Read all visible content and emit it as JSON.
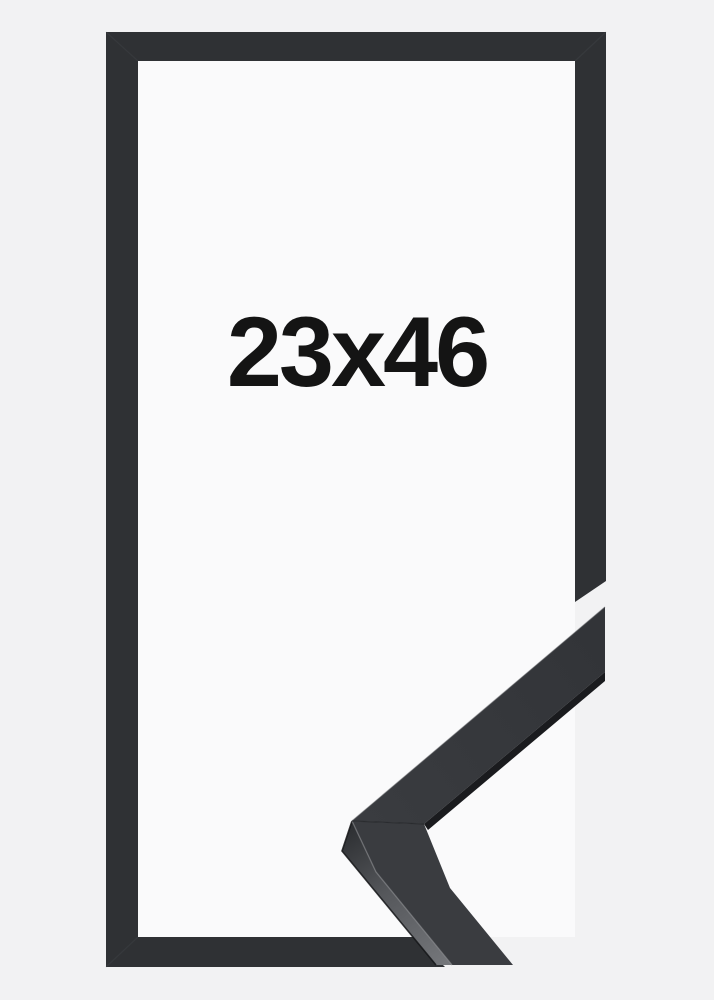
{
  "product": {
    "size_label": "23x46"
  },
  "scene": {
    "background_color": "#f2f2f3",
    "frame_color": "#2f3134",
    "frame_interior_color": "#fafafb",
    "label_color": "#141414",
    "corner_seam_color": "#54565a",
    "sample": {
      "face_upper": "#323438",
      "face_lower": "#3a3c40",
      "rabbet_shadow": "#1a1b1e",
      "side_dark": "#2b2d30",
      "side_mid": "#55575b",
      "side_light": "#75777b",
      "crease_highlight": "#85878b",
      "outer_bevel_highlight": "#4b4d51",
      "miter_seam": "#222427",
      "silhouette_edge": "#141518"
    }
  }
}
